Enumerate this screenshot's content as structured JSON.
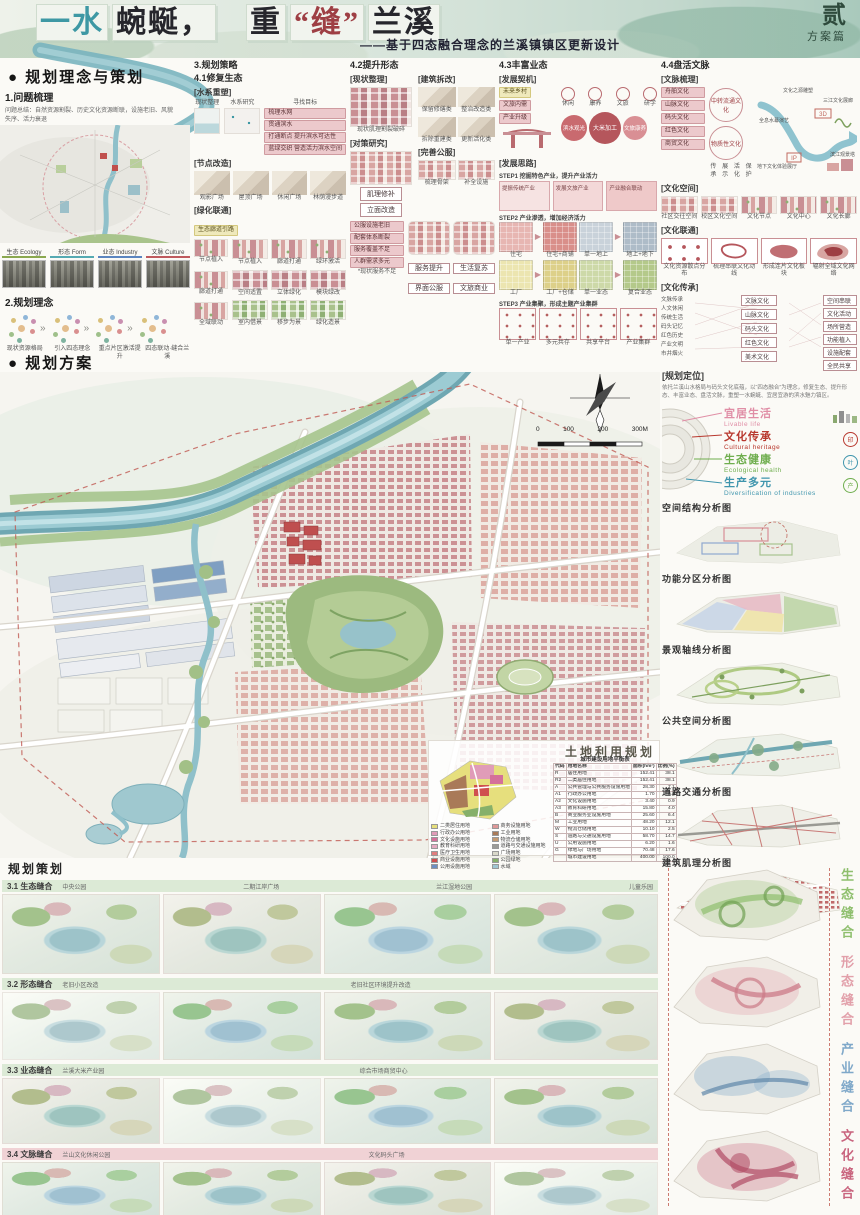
{
  "header": {
    "segments": [
      {
        "t": "一水",
        "c": "#3e98a4"
      },
      {
        "t": "蜿蜒，",
        "c": "#26262c"
      },
      {
        "t": "重",
        "c": "#26262c"
      },
      {
        "t": "“缝”",
        "c": "#9e3f44"
      },
      {
        "t": "兰溪",
        "c": "#26262c"
      }
    ],
    "subtitle": "——基于四态融合理念的兰溪镇镇区更新设计",
    "volume": "贰",
    "volume_sub": "方案篇"
  },
  "concept": {
    "heading": "● 规划理念与策划",
    "problem_title": "1.问题梳理",
    "problem_desc": "问题总结：自然资源割裂、历史文化资源断联，设施老旧、风貌失序、活力衰退",
    "photo_tags": [
      {
        "label": "生态 Ecology",
        "color": "#8aa84f"
      },
      {
        "label": "形态 Form",
        "color": "#55aab2"
      },
      {
        "label": "业态 Industry",
        "color": "#5b85c0"
      },
      {
        "label": "文脉 Culture",
        "color": "#bf5a5e"
      }
    ],
    "idea_title": "2.规划理念",
    "idea_captions": [
      "现状资源格局",
      "引入四态理念",
      "重点片区激活提升",
      "四态联动·缝合兰溪"
    ]
  },
  "strategy": {
    "heading": "3.规划策略",
    "s41": {
      "title": "4.1修复生态",
      "g_water": "[水系重塑]",
      "water_heads": [
        "现状整理",
        "水系研究",
        "寻找目标"
      ],
      "water_goals": [
        "梳理水网",
        "贯通滨水",
        "打通断点 提升滨水可达性",
        "蓝绿交织 营造活力滨水空间"
      ],
      "g_node": "[节点改造]",
      "nodes": [
        "观影广场",
        "屋顶广场",
        "休闲广场",
        "林荫漫步道"
      ],
      "g_green": "[绿化联通]",
      "green_chip": "生态廊道引路",
      "grid": [
        "节点植入",
        "廊道打通",
        "绿环激活",
        "空间适置",
        "立体绿化",
        "模块绿改",
        "室内借景",
        "移步为景",
        "绿化造景"
      ],
      "side": [
        "节点植入",
        "廊道打通",
        "全域联动"
      ]
    },
    "s42": {
      "title": "4.2提升形态",
      "g_now": "[现状整理]",
      "now_cap": "现状肌理割裂破碎",
      "g_tactic": "[对策研究]",
      "tactics": [
        "肌理修补",
        "立面改造"
      ],
      "g_demo": "[建筑拆改]",
      "demo": [
        "保留修缮类",
        "整治改造类",
        "拆除重建类",
        "更新活化类"
      ],
      "g_pub": "[完善公服]",
      "pub_caps": [
        "梳理骨架",
        "补全设施"
      ],
      "stack": [
        "公服设施老旧",
        "配套体系断裂",
        "服务覆盖不足",
        "人群需求多元"
      ],
      "stack_cap": "*现状服务不足",
      "blocks": [
        "服务提升",
        "生活复苏"
      ],
      "chips": [
        "界面公服",
        "文旅商业"
      ]
    },
    "s43": {
      "title": "4.3丰富业态",
      "g_ops": "[发展契机]",
      "ops": [
        "未来乡村",
        "文旅内需",
        "产业升级"
      ],
      "icons": [
        "休闲",
        "康养",
        "文旅",
        "研学"
      ],
      "bubbles": [
        "滨水观光",
        "大米加工",
        "文旅康养"
      ],
      "g_idea": "[发展思路]",
      "step1": "STEP1 挖掘特色产业，提升产业活力",
      "panels": [
        "提振传统产业",
        "发展文旅产业",
        "产业融合联动"
      ],
      "step2": "STEP2 产业渗透，增加经济活力",
      "cells2": [
        "住宅",
        "住宅+商铺",
        "单一地上",
        "地上+地下",
        "工厂",
        "工厂+仓储",
        "单一业态",
        "复合业态"
      ],
      "step3": "STEP3 产业集聚，形成主题产业集群",
      "cells3": [
        "单一产业",
        "多元共存",
        "共享平台",
        "产业集群"
      ]
    },
    "s44": {
      "title": "4.4盘活文脉",
      "g_sort": "[文脉梳理]",
      "cultures": [
        "舟舶文化",
        "山脉文化",
        "码头文化",
        "红色文化",
        "商贸文化"
      ],
      "clusters": [
        "中转流通文化",
        "物质性文化"
      ],
      "cluster_words": [
        "传承",
        "展示",
        "活化",
        "保护"
      ],
      "axis_start": "文化之源雕塑",
      "axis_end": "三江文化展廊",
      "river_tags": [
        "全息水幕演艺",
        "3D",
        "投影展厅",
        "IP",
        "印象兰溪",
        "地下文化体验展厅",
        "文化驿站",
        "滨江观景塔",
        "文创市集"
      ],
      "g_space": "[文化空间]",
      "spaces": [
        "社区交往空间",
        "校区文化空间",
        "文化节点",
        "文化中心",
        "文化长廊"
      ],
      "g_link": "[文化联通]",
      "link_caps": [
        "文化资源散点分布",
        "梳理串联文化动线",
        "形成连片文化板块",
        "辐射全域文化网络"
      ],
      "g_inherit": "[文化传承]",
      "inherit_left": [
        "文脉传承",
        "人文休闲",
        "传统生活",
        "码头记忆",
        "红色历史",
        "产业文明",
        "市井烟火"
      ],
      "inherit_mid": [
        "文脉文化",
        "山脉文化",
        "码头文化",
        "红色文化",
        "美术文化"
      ],
      "inherit_right": [
        "空间串联",
        "文化活动",
        "场所营造",
        "功能植入",
        "设施配套",
        "全民共享"
      ]
    }
  },
  "master": {
    "heading": "● 规划方案",
    "plan_label": "总平面图",
    "scale_ticks": [
      "0",
      "100",
      "200",
      "300M"
    ],
    "landuse": {
      "title": "土地利用规划",
      "table_title": "城市建设用地平衡表",
      "columns": [
        "代码",
        "用地名称",
        "面积(hm²)",
        "比例(%)"
      ],
      "rows": [
        [
          "R",
          "居住用地",
          "152.41",
          "38.1"
        ],
        [
          "R2",
          "二类居住用地",
          "152.41",
          "38.1"
        ],
        [
          "A",
          "公共管理与公共服务设施用地",
          "28.30",
          "7.1"
        ],
        [
          "A1",
          "行政办公用地",
          "1.70",
          "0.4"
        ],
        [
          "A2",
          "文化设施用地",
          "3.40",
          "0.9"
        ],
        [
          "A3",
          "教育科研用地",
          "15.80",
          "4.0"
        ],
        [
          "B",
          "商业服务业设施用地",
          "25.60",
          "6.4"
        ],
        [
          "M",
          "工业用地",
          "48.20",
          "12.1"
        ],
        [
          "W",
          "物流仓储用地",
          "10.10",
          "2.5"
        ],
        [
          "S",
          "道路与交通设施用地",
          "58.70",
          "14.7"
        ],
        [
          "U",
          "公用设施用地",
          "6.20",
          "1.6"
        ],
        [
          "G",
          "绿地与广场用地",
          "70.48",
          "17.6"
        ],
        [
          "",
          "城市建设用地",
          "400.00",
          "100.0"
        ]
      ],
      "legend": [
        {
          "label": "二类居住用地",
          "color": "#e6df7d"
        },
        {
          "label": "行政办公用地",
          "color": "#e09cb8"
        },
        {
          "label": "文化设施用地",
          "color": "#d4709a"
        },
        {
          "label": "教育科研用地",
          "color": "#e4a9c1"
        },
        {
          "label": "医疗卫生用地",
          "color": "#e07d7d"
        },
        {
          "label": "商业设施用地",
          "color": "#cf4f4f"
        },
        {
          "label": "公用设施用地",
          "color": "#6d8fc2"
        },
        {
          "label": "商务设施用地",
          "color": "#de9898"
        },
        {
          "label": "工业用地",
          "color": "#a97a58"
        },
        {
          "label": "物流仓储用地",
          "color": "#c49a72"
        },
        {
          "label": "道路与交通设施用地",
          "color": "#9c9c98"
        },
        {
          "label": "广场用地",
          "color": "#d9d9ca"
        },
        {
          "label": "公园绿地",
          "color": "#86b06a"
        },
        {
          "label": "水域",
          "color": "#9fc6d2"
        }
      ]
    }
  },
  "sidebar": {
    "pos_title": "[规划定位]",
    "pos_desc": "依托兰溪山水格局与码头文化底蕴，以“四态融合”为理念，修复生态、提升形态、丰富业态、盘活文脉，重塑一水蜿蜒、宜居宜游的滨水魅力镇区。",
    "goals": [
      {
        "zh": "宜居生活",
        "en": "Livable life",
        "color": "#e08ea6"
      },
      {
        "zh": "文化传承",
        "en": "Cultural heritage",
        "color": "#b8382e"
      },
      {
        "zh": "生态健康",
        "en": "Ecological health",
        "color": "#6fae4e"
      },
      {
        "zh": "生产多元",
        "en": "Diversification of industries",
        "color": "#3f95ad"
      }
    ],
    "maps": [
      "空间结构分析图",
      "功能分区分析图",
      "景观轴线分析图",
      "公共空间分析图",
      "道路交通分析图",
      "建筑肌理分析图"
    ]
  },
  "projects": {
    "heading": "规划策划",
    "rows": [
      {
        "no": "3.1",
        "title": "3.1 生态缝合",
        "tags": [
          "中央公园",
          "二期江岸广场",
          "兰江湿地公园",
          "儿童乐园"
        ]
      },
      {
        "no": "3.2",
        "title": "3.2 形态缝合",
        "tags": [
          "老旧小区改造",
          "老旧社区环境提升改造"
        ]
      },
      {
        "no": "3.3",
        "title": "3.3 业态缝合",
        "tags": [
          "兰溪大米产业园",
          "综合市场商贸中心"
        ]
      },
      {
        "no": "3.4",
        "title": "3.4 文脉缝合",
        "tags": [
          "兰山文化休闲公园",
          "文化码头广场"
        ]
      }
    ]
  },
  "layers": [
    {
      "label": "生态缝合",
      "color": "#8fbf6e"
    },
    {
      "label": "形态缝合",
      "color": "#e2a0aa"
    },
    {
      "label": "产业缝合",
      "color": "#7fa8c9"
    },
    {
      "label": "文化缝合",
      "color": "#c9647e"
    }
  ]
}
